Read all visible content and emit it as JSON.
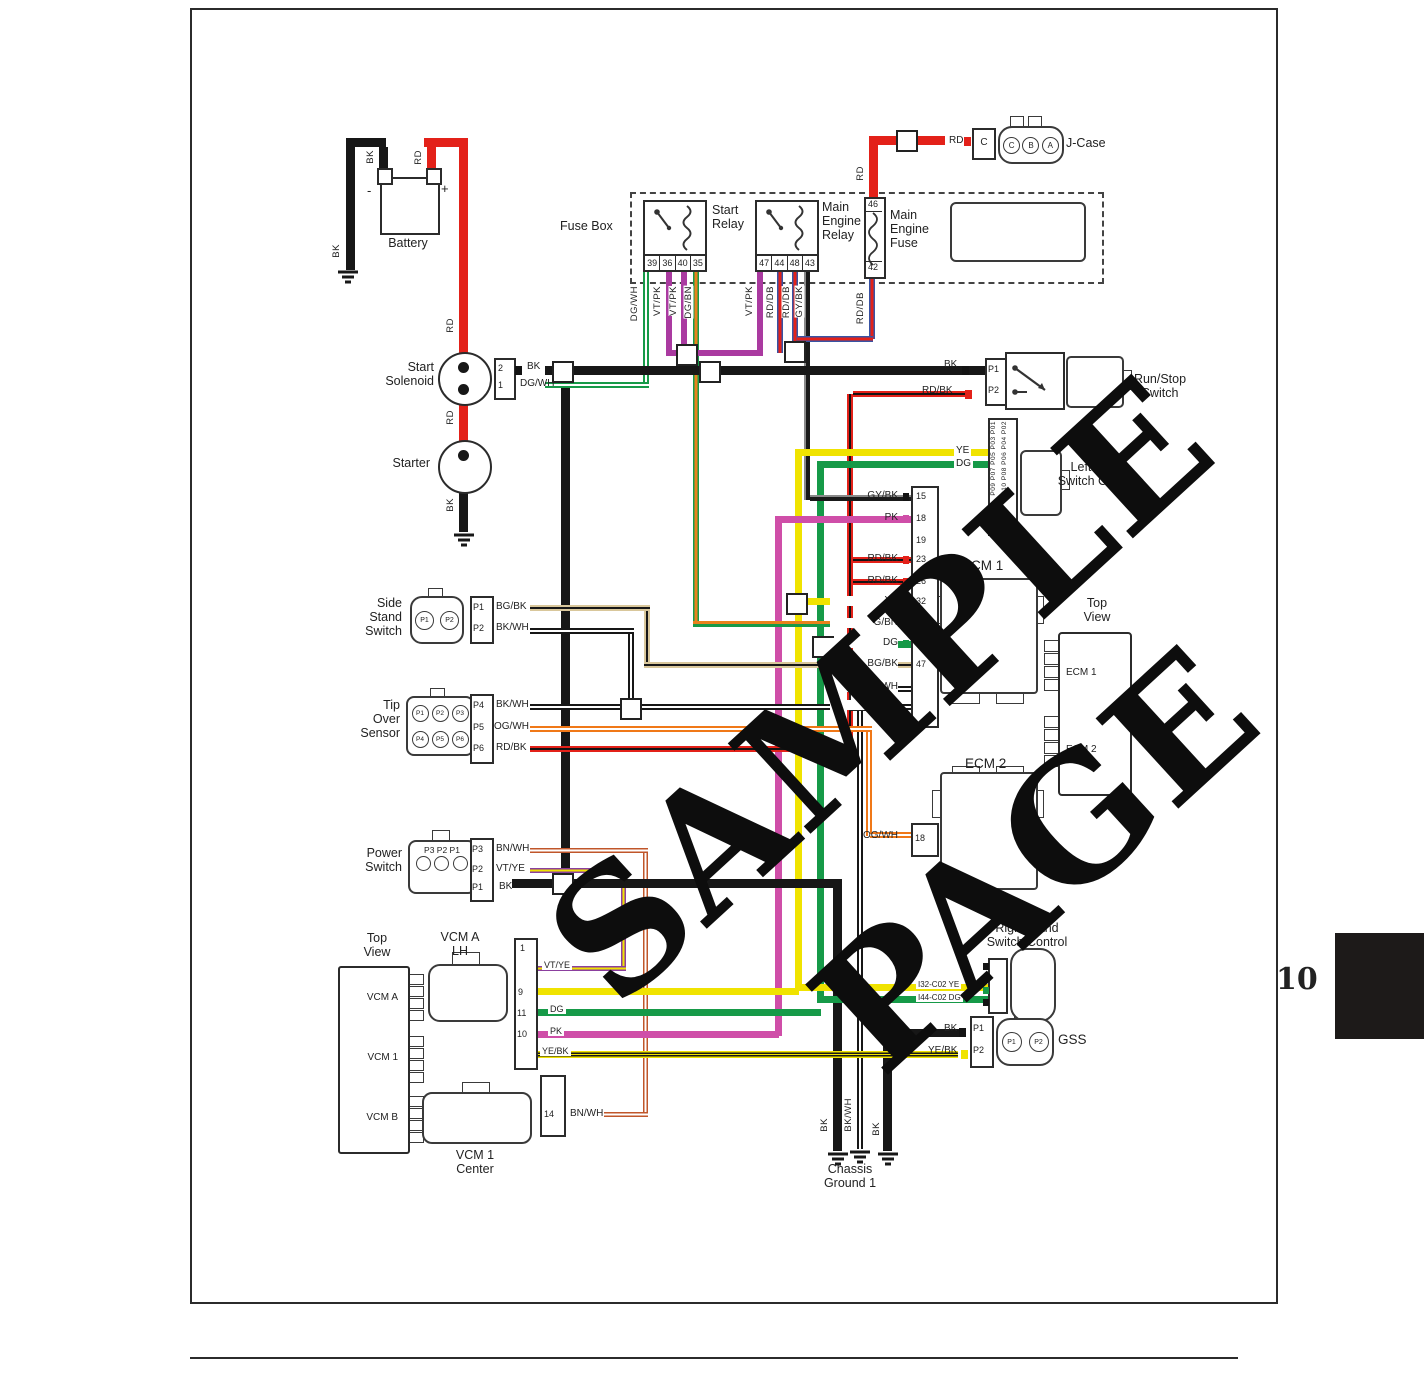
{
  "watermark": "SAMPLE PAGE",
  "page": {
    "number": "10"
  },
  "battery": {
    "label": "Battery",
    "minus": "-",
    "plus": "+",
    "bk_top": "BK",
    "rd_top": "RD",
    "bk_side": "BK",
    "rd_mid": "RD"
  },
  "start_solenoid": {
    "line1": "Start",
    "line2": "Solenoid",
    "pin2": "2",
    "pin2_wire": "BK",
    "pin1": "1",
    "pin1_wire": "DG/WH",
    "rd": "RD"
  },
  "starter": {
    "label": "Starter",
    "bk": "BK"
  },
  "fuse_box": {
    "label": "Fuse Box"
  },
  "start_relay": {
    "line1": "Start",
    "line2": "Relay",
    "pins": [
      "39",
      "36",
      "40",
      "35"
    ]
  },
  "main_engine_relay": {
    "line1": "Main",
    "line2": "Engine",
    "line3": "Relay",
    "pins": [
      "47",
      "44",
      "48",
      "43"
    ]
  },
  "main_engine_fuse": {
    "line1": "Main",
    "line2": "Engine",
    "line3": "Fuse",
    "pin_top": "46",
    "pin_bottom": "42",
    "rd": "RD",
    "rddb": "RD/DB"
  },
  "jcase": {
    "rd": "RD",
    "c_box": "C",
    "pins": [
      "C",
      "B",
      "A"
    ],
    "label": "J-Case"
  },
  "drop_wires": {
    "dgwh": "DG/WH",
    "vtpk1": "VT/PK",
    "vtpk2": "VT/PK",
    "dgbn": "DG/BN",
    "vtpk3": "VT/PK",
    "rddb1": "RD/DB",
    "rddb2": "RD/DB",
    "gybk": "GY/BK"
  },
  "runstop": {
    "bk_start": "BK",
    "bk_end": "BK",
    "p1": "P1",
    "rdbk": "RD/BK",
    "p2": "P2",
    "line1": "Run/Stop",
    "line2": "Switch"
  },
  "lh_control": {
    "ye": "YE",
    "dg": "DG",
    "pins_col1": "P09 P07 P05 P03 P01",
    "pins_col2": "P10 P08 P06 P04 P02",
    "line1": "Left-Hand",
    "line2": "Switch Control"
  },
  "ecm1": {
    "label": "ECM 1",
    "pins": [
      {
        "num": "15",
        "wire": "GY/BK"
      },
      {
        "num": "18",
        "wire": "PK"
      },
      {
        "num": "19",
        "wire": ""
      },
      {
        "num": "23",
        "wire": "RD/BK"
      },
      {
        "num": "26",
        "wire": "RD/BK"
      },
      {
        "num": "32",
        "wire": "YE"
      },
      {
        "num": "",
        "wire": "G/BN"
      },
      {
        "num": "",
        "wire": "DG"
      },
      {
        "num": "47",
        "wire": "BG/BK"
      },
      {
        "num": "",
        "wire": "BK/WH"
      },
      {
        "num": "",
        "wire": "BK/WH"
      }
    ]
  },
  "ecm_top_view": {
    "line1": "Top",
    "line2": "View",
    "ecm1": "ECM 1",
    "ecm2": "ECM 2"
  },
  "ecm2": {
    "label": "ECM 2",
    "pin": "18",
    "wire": "OG/WH"
  },
  "side_stand": {
    "line1": "Side",
    "line2": "Stand",
    "line3": "Switch",
    "c1": "P1",
    "c2": "P2",
    "p1": "P1",
    "p1_wire": "BG/BK",
    "p2": "P2",
    "p2_wire": "BK/WH"
  },
  "tip_over": {
    "line1": "Tip",
    "line2": "Over",
    "line3": "Sensor",
    "circles": [
      "P1",
      "P2",
      "P3",
      "P4",
      "P5",
      "P6"
    ],
    "p4": "P4",
    "p4_wire": "BK/WH",
    "p5": "P5",
    "p5_wire": "OG/WH",
    "p6": "P6",
    "p6_wire": "RD/BK"
  },
  "power_switch": {
    "line1": "Power",
    "line2": "Switch",
    "conn_label": "P3 P2 P1",
    "p3": "P3",
    "p3_wire": "BN/WH",
    "p2": "P2",
    "p2_wire": "VT/YE",
    "p1": "P1",
    "p1_wire": "BK"
  },
  "vcm_top_view": {
    "line1": "Top",
    "line2": "View",
    "a": "VCM A",
    "v1": "VCM 1",
    "b": "VCM B"
  },
  "vcm_a": {
    "line1": "VCM A",
    "line2": "LH",
    "pin1": "1",
    "vtye": "VT/YE",
    "pin9": "9",
    "pin11": "11",
    "dg": "DG",
    "pin10": "10",
    "pk": "PK",
    "yebk": "YE/BK"
  },
  "vcm1": {
    "line1": "VCM 1",
    "line2": "Center",
    "pin14": "14",
    "bnwh": "BN/WH"
  },
  "rh_control": {
    "line1": "Right-Hand",
    "line2": "Switch Control",
    "ye_label": "I32-C02 YE",
    "dg_label": "I44-C02 DG"
  },
  "gss": {
    "bk": "BK",
    "p1": "P1",
    "yebk": "YE/BK",
    "p2": "P2",
    "c1": "P1",
    "c2": "P2",
    "label": "GSS"
  },
  "chassis_ground": {
    "bk1": "BK",
    "bkwh": "BK/WH",
    "bk2": "BK",
    "line1": "Chassis",
    "line2": "Ground 1"
  }
}
